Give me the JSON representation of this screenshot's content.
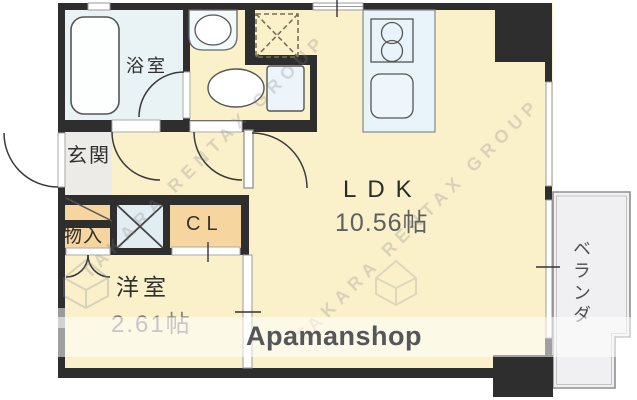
{
  "plan_title": "apartment floor plan",
  "rooms": {
    "bathroom": {
      "label": "浴室"
    },
    "entrance": {
      "label": "玄関"
    },
    "storage": {
      "label": "物入"
    },
    "closet": {
      "label": "CL"
    },
    "western_room": {
      "label": "洋室",
      "size": "2.61帖"
    },
    "ldk": {
      "label": "LDK",
      "size": "10.56帖"
    },
    "veranda": {
      "label": "ベランダ"
    }
  },
  "fixtures": {
    "bathtub": "bathtub-icon",
    "washbasin": "washbasin-icon",
    "toilet": "toilet-icon",
    "washing_machine_area": "washing-machine-dashed-box-icon",
    "stove": "stove-two-burner-icon",
    "kitchen_sink": "kitchen-sink-icon",
    "pipe_space": "crossed-box-icon"
  },
  "branding": {
    "banner_brand": "Apamanshop",
    "diagonal_watermark": "TAKARA RENTAX GROUP"
  },
  "colors": {
    "wall": "#2e2e2e",
    "room_yellow": "#faf1ca",
    "closet_orange": "#f6d69e",
    "bathroom_blue": "#e9f2f4",
    "fixture_blue": "#e9f3fa",
    "entrance_gray": "#edebe7",
    "veranda_gray": "#f0f0f2",
    "banner_overlay": "rgba(255,255,255,0.55)",
    "brand_text": "#55565a"
  }
}
